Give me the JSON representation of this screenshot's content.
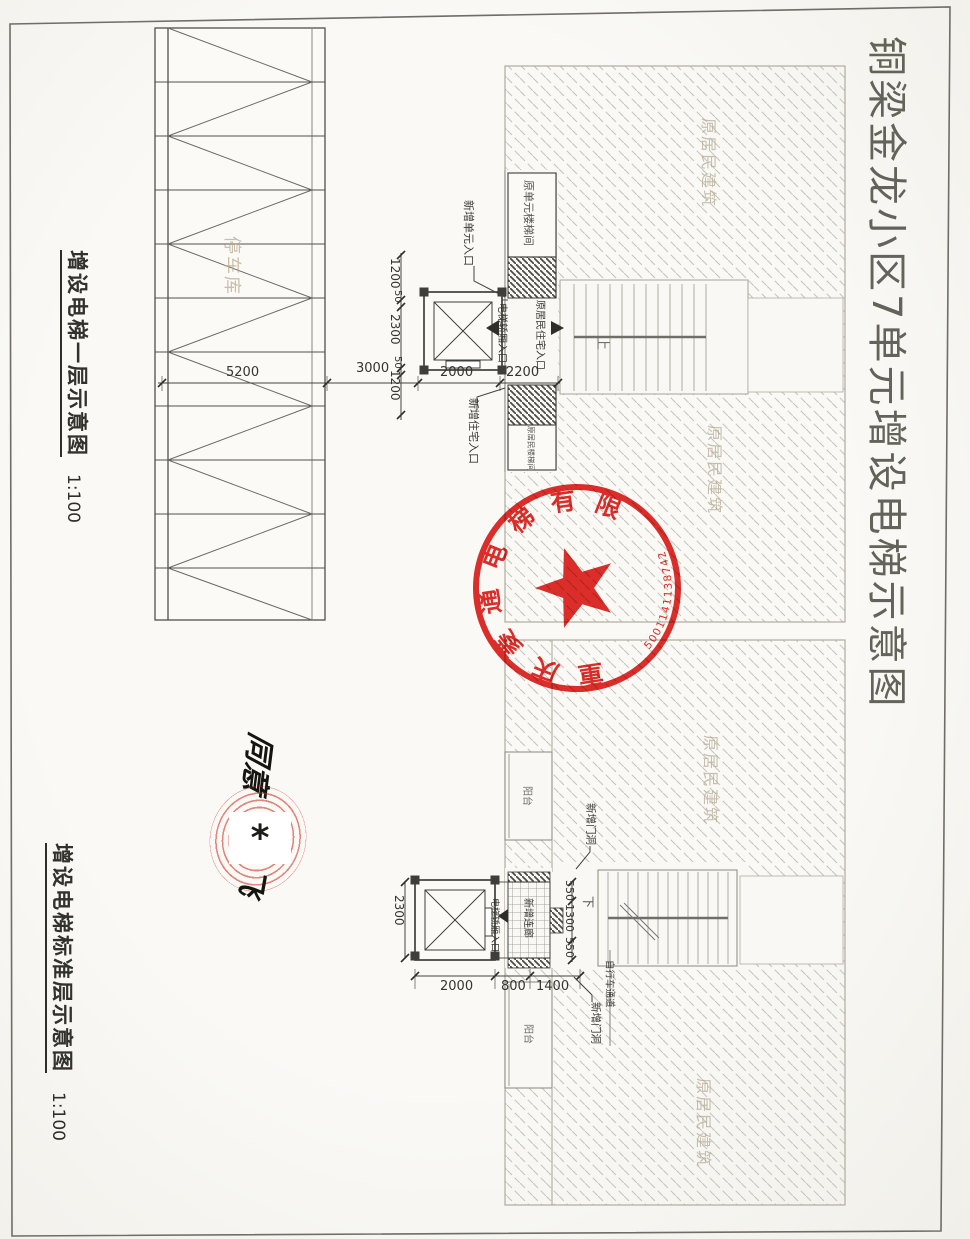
{
  "sheet": {
    "title": "铜梁金龙小区7单元增设电梯示意图"
  },
  "plans": {
    "first_floor": {
      "caption": "增设电梯一层示意图",
      "scale": "1:100"
    },
    "standard_floor": {
      "caption": "增设电梯标准层示意图",
      "scale": "1:100"
    }
  },
  "stamp": {
    "company": "重庆菱通电梯有限公司",
    "serial": "5001141138742",
    "color": "#dd1712",
    "star": "★"
  },
  "approval": {
    "note": "同意",
    "signature": "飞",
    "redaction_mark": "*"
  },
  "floor1": {
    "labels": {
      "parking": "停车库",
      "building_upper": "原居民建筑",
      "building_lower": "原居民建筑",
      "stair_box_upper": "原单元楼梯间",
      "stair_box_lower": "原居民楼梯间",
      "new_unit_entrance": "新增单元入口",
      "new_house_entrance": "新增住宅入口",
      "elevator_car_entrance": "电梯轿厢入口",
      "old_resident_entrance": "原居民住宅入口",
      "stair_up": "上"
    },
    "dims": {
      "horizontal": [
        "5200",
        "3000",
        "2000",
        "2200"
      ],
      "vertical": [
        "1200",
        "50",
        "2300",
        "50",
        "1200"
      ]
    }
  },
  "floor_std": {
    "labels": {
      "building_upper": "原居民建筑",
      "building_lower": "原居民建筑",
      "balcony_upper": "阳台",
      "balcony_lower": "阳台",
      "corridor": "新增连廊",
      "new_door_upper": "新增门洞",
      "new_door_lower": "新增门洞",
      "bike_passage": "自行车通道",
      "elevator_car_entrance": "电梯轿厢入口",
      "stair_down": "下"
    },
    "dims": {
      "horizontal": [
        "2000",
        "800",
        "1400"
      ],
      "vertical_left": "2300",
      "vertical_right": [
        "550",
        "1300",
        "550"
      ]
    }
  }
}
